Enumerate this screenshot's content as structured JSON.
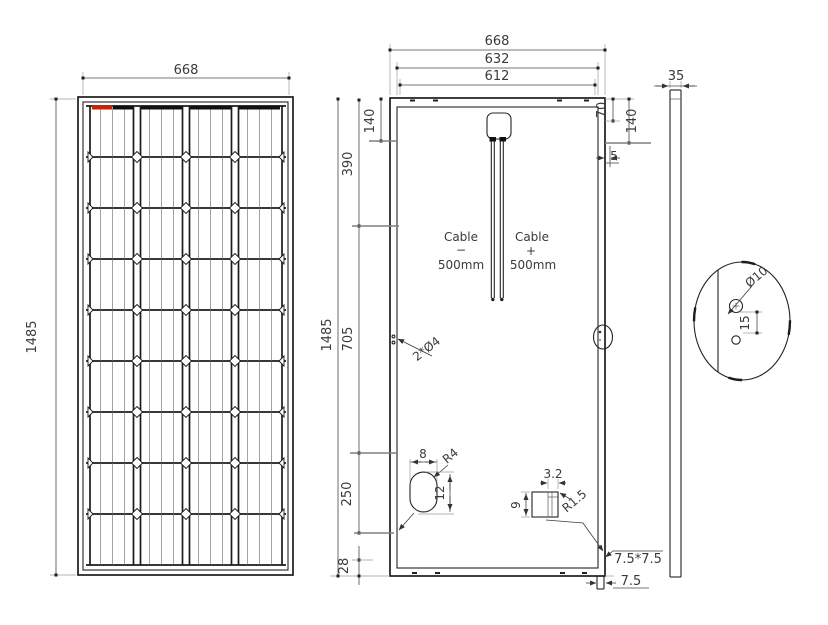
{
  "front": {
    "width": "668",
    "height": "1485"
  },
  "back": {
    "width_outer": "668",
    "width_mid": "632",
    "width_inner": "612",
    "offset_top": "140",
    "seg_upper": "390",
    "height_total": "1485",
    "seg_mid": "705",
    "seg_lower": "250",
    "seg_bottom": "28",
    "right_offset_70": "70",
    "right_offset_140": "140",
    "right_offset_5": "5",
    "cable_left": {
      "word": "Cable",
      "sign": "−",
      "length": "500mm"
    },
    "cable_right": {
      "word": "Cable",
      "sign": "+",
      "length": "500mm"
    },
    "frame_holes_note": "2*Ø4",
    "drain_hole": {
      "width": "8",
      "radius": "R4",
      "height": "12"
    },
    "notch": {
      "width": "3.2",
      "height": "9",
      "radius": "R1.5"
    },
    "corner_cut": "7.5*7.5",
    "corner_width": "7.5"
  },
  "side": {
    "thickness": "35"
  },
  "detail": {
    "hole_diameter": "Ø10",
    "hole_offset": "15"
  },
  "colors": {
    "line": "#242424",
    "dim_text": "#3a3a3a",
    "ribbon_red": "#cc2200"
  }
}
